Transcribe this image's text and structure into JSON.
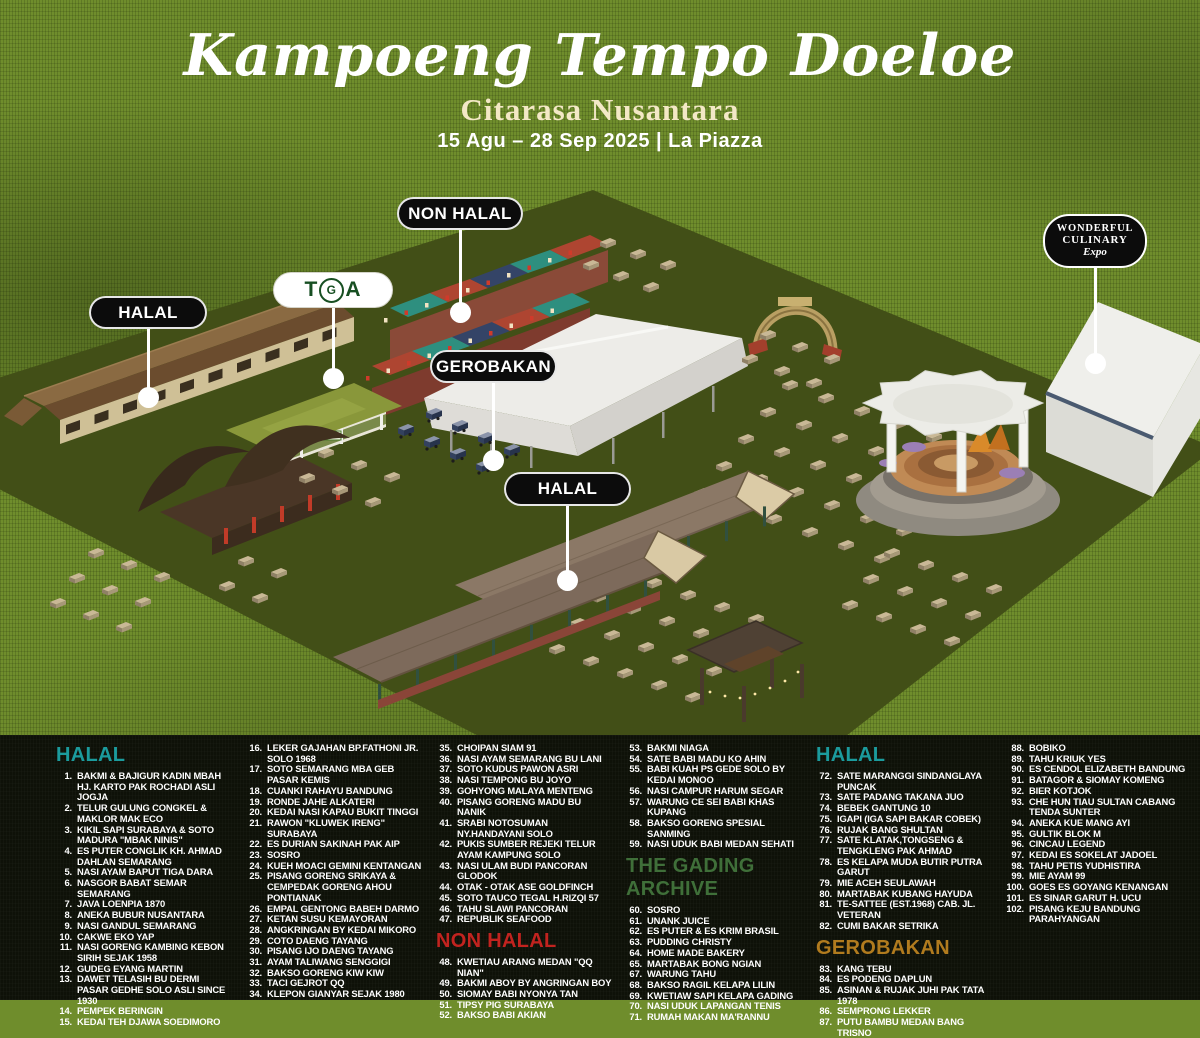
{
  "header": {
    "title": "Kampoeng Tempo Doeloe",
    "subtitle": "Citarasa Nusantara",
    "date_line": "15 Agu – 28 Sep 2025 | La Piazza"
  },
  "colors": {
    "halal_teal": "#1b9b9d",
    "non_halal_red": "#c2231f",
    "gading_green": "#3f6f39",
    "gerobakan_orange": "#b17b1e",
    "cream": "#f3e8c6",
    "ground_light": "#6f8d2c",
    "ground_dark": "#424f17",
    "panel_black": "#0e1108"
  },
  "map": {
    "labels": [
      {
        "id": "halal-west",
        "text": "HALAL",
        "style": "black"
      },
      {
        "id": "tga",
        "text": "TGA",
        "style": "tga"
      },
      {
        "id": "non-halal",
        "text": "NON HALAL",
        "style": "black"
      },
      {
        "id": "gerobakan",
        "text": "GEROBAKAN",
        "style": "black"
      },
      {
        "id": "halal-central",
        "text": "HALAL",
        "style": "black"
      },
      {
        "id": "wce",
        "style": "logo",
        "lines": [
          "WONDERFUL",
          "CULINARY",
          "Expo"
        ]
      }
    ]
  },
  "legend": {
    "columns": [
      {
        "blocks": [
          {
            "header": "HALAL",
            "color": "#1b9b9d"
          },
          {
            "items": [
              [
                "1",
                "BAKMI & BAJIGUR KADIN MBAH HJ. KARTO PAK ROCHADI ASLI JOGJA"
              ],
              [
                "2",
                "TELUR GULUNG CONGKEL & MAKLOR MAK ECO"
              ],
              [
                "3",
                "KIKIL SAPI SURABAYA & SOTO MADURA \"MBAK NINIS\""
              ],
              [
                "4",
                "ES PUTER CONGLIK KH. AHMAD DAHLAN SEMARANG"
              ],
              [
                "5",
                "NASI AYAM BAPUT TIGA DARA"
              ],
              [
                "6",
                "NASGOR BABAT SEMAR SEMARANG"
              ],
              [
                "7",
                "JAVA LOENPIA 1870"
              ],
              [
                "8",
                "ANEKA BUBUR NUSANTARA"
              ],
              [
                "9",
                "NASI GANDUL SEMARANG"
              ],
              [
                "10",
                "CAKWE EKO YAP"
              ],
              [
                "11",
                "NASI GORENG KAMBING KEBON SIRIH SEJAK 1958"
              ],
              [
                "12",
                "GUDEG EYANG MARTIN"
              ],
              [
                "13",
                "DAWET TELASIH BU DERMI PASAR GEDHE SOLO ASLI SINCE 1930"
              ],
              [
                "14",
                "PEMPEK BERINGIN"
              ],
              [
                "15",
                "KEDAI TEH DJAWA SOEDIMORO"
              ]
            ]
          }
        ]
      },
      {
        "blocks": [
          {
            "items": [
              [
                "16",
                "LEKER GAJAHAN BP.FATHONI JR. SOLO 1968"
              ],
              [
                "17",
                "SOTO SEMARANG MBA GEB PASAR KEMIS"
              ],
              [
                "18",
                "CUANKI RAHAYU BANDUNG"
              ],
              [
                "19",
                "RONDE JAHE ALKATERI"
              ],
              [
                "20",
                "KEDAI NASI KAPAU BUKIT TINGGI"
              ],
              [
                "21",
                "RAWON \"KLUWEK IRENG\" SURABAYA"
              ],
              [
                "22",
                "ES DURIAN SAKINAH PAK AIP"
              ],
              [
                "23",
                "SOSRO"
              ],
              [
                "24",
                "KUEH MOACI GEMINI KENTANGAN"
              ],
              [
                "25",
                "PISANG GORENG SRIKAYA & CEMPEDAK GORENG AHOU PONTIANAK"
              ],
              [
                "26",
                "EMPAL GENTONG BABEH DARMO"
              ],
              [
                "27",
                "KETAN SUSU KEMAYORAN"
              ],
              [
                "28",
                "ANGKRINGAN BY KEDAI MIKORO"
              ],
              [
                "29",
                "COTO DAENG TAYANG"
              ],
              [
                "30",
                "PISANG IJO DAENG TAYANG"
              ],
              [
                "31",
                "AYAM TALIWANG SENGGIGI"
              ],
              [
                "32",
                "BAKSO GORENG KIW KIW"
              ],
              [
                "33",
                "TACI GEJROT QQ"
              ],
              [
                "34",
                "KLEPON GIANYAR SEJAK 1980"
              ]
            ]
          }
        ]
      },
      {
        "blocks": [
          {
            "items": [
              [
                "35",
                "CHOIPAN SIAM 91"
              ],
              [
                "36",
                "NASI AYAM SEMARANG BU LANI"
              ],
              [
                "37",
                "SOTO KUDUS PAWON ASRI"
              ],
              [
                "38",
                "NASI TEMPONG BU JOYO"
              ],
              [
                "39",
                "GOHYONG MALAYA MENTENG"
              ],
              [
                "40",
                "PISANG GORENG MADU BU NANIK"
              ],
              [
                "41",
                "SRABI NOTOSUMAN NY.HANDAYANI SOLO"
              ],
              [
                "42",
                "PUKIS SUMBER REJEKI TELUR AYAM KAMPUNG SOLO"
              ],
              [
                "43",
                "NASI ULAM BUDI PANCORAN GLODOK"
              ],
              [
                "44",
                "OTAK - OTAK ASE GOLDFINCH"
              ],
              [
                "45",
                "SOTO TAUCO TEGAL H.RIZQI 57"
              ],
              [
                "46",
                "TAHU SLAWI PANCORAN"
              ],
              [
                "47",
                "REPUBLIK SEAFOOD"
              ]
            ]
          },
          {
            "header": "NON HALAL",
            "color": "#c2231f",
            "mid": true
          },
          {
            "items": [
              [
                "48",
                "KWETIAU ARANG MEDAN \"QQ NIAN\""
              ],
              [
                "49",
                "BAKMI ABOY BY ANGRINGAN BOY"
              ],
              [
                "50",
                "SIOMAY BABI NYONYA TAN"
              ],
              [
                "51",
                "TIPSY PIG SURABAYA"
              ],
              [
                "52",
                "BAKSO BABI AKIAN"
              ]
            ]
          }
        ]
      },
      {
        "blocks": [
          {
            "items": [
              [
                "53",
                "BAKMI NIAGA"
              ],
              [
                "54",
                "SATE BABI MADU KO AHIN"
              ],
              [
                "55",
                "BABI KUAH PS GEDE SOLO BY KEDAI MONOO"
              ],
              [
                "56",
                "NASI CAMPUR HARUM SEGAR"
              ],
              [
                "57",
                "WARUNG CE SEI BABI KHAS KUPANG"
              ],
              [
                "58",
                "BAKSO GORENG SPESIAL SANMING"
              ],
              [
                "59",
                "NASI UDUK BABI MEDAN SEHATI"
              ]
            ]
          },
          {
            "header": "THE GADING ARCHIVE",
            "color": "#3f6f39",
            "mid": true
          },
          {
            "items": [
              [
                "60",
                "SOSRO"
              ],
              [
                "61",
                "UNANK JUICE"
              ],
              [
                "62",
                "ES PUTER & ES KRIM BRASIL"
              ],
              [
                "63",
                "PUDDING CHRISTY"
              ],
              [
                "64",
                "HOME MADE BAKERY"
              ],
              [
                "65",
                "MARTABAK BONG NGIAN"
              ],
              [
                "67",
                "WARUNG TAHU"
              ],
              [
                "68",
                "BAKSO RAGIL KELAPA LILIN"
              ],
              [
                "69",
                "KWETIAW SAPI KELAPA GADING"
              ],
              [
                "70",
                "NASI UDUK LAPANGAN TENIS"
              ],
              [
                "71",
                "RUMAH MAKAN MA'RANNU"
              ]
            ]
          }
        ]
      },
      {
        "blocks": [
          {
            "header": "HALAL",
            "color": "#1b9b9d"
          },
          {
            "items": [
              [
                "72",
                "SATE MARANGGI SINDANGLAYA PUNCAK"
              ],
              [
                "73",
                "SATE PADANG TAKANA JUO"
              ],
              [
                "74",
                "BEBEK GANTUNG 10"
              ],
              [
                "75",
                "IGAPI (IGA SAPI BAKAR COBEK)"
              ],
              [
                "76",
                "RUJAK BANG SHULTAN"
              ],
              [
                "77",
                "SATE KLATAK,TONGSENG & TENGKLENG PAK AHMAD"
              ],
              [
                "78",
                "ES KELAPA MUDA BUTIR PUTRA GARUT"
              ],
              [
                "79",
                "MIE ACEH SEULAWAH"
              ],
              [
                "80",
                "MARTABAK KUBANG HAYUDA"
              ],
              [
                "81",
                "TE-SATTEE (EST.1968) CAB. JL. VETERAN"
              ],
              [
                "82",
                "CUMI BAKAR SETRIKA"
              ]
            ]
          },
          {
            "header": "GEROBAKAN",
            "color": "#b17b1e",
            "mid": true
          },
          {
            "items": [
              [
                "83",
                "KANG TEBU"
              ],
              [
                "84",
                "ES PODENG DAPLUN"
              ],
              [
                "85",
                "ASINAN & RUJAK JUHI PAK TATA 1978"
              ],
              [
                "86",
                "SEMPRONG LEKKER"
              ],
              [
                "87",
                "PUTU BAMBU MEDAN BANG TRISNO"
              ]
            ]
          }
        ]
      },
      {
        "blocks": [
          {
            "items": [
              [
                "88",
                "BOBIKO"
              ],
              [
                "89",
                "TAHU KRIUK YES"
              ],
              [
                "90",
                "ES CENDOL ELIZABETH BANDUNG"
              ],
              [
                "91",
                "BATAGOR & SIOMAY KOMENG"
              ],
              [
                "92",
                "BIER KOTJOK"
              ],
              [
                "93",
                "CHE HUN TIAU SULTAN CABANG TENDA SUNTER"
              ],
              [
                "94",
                "ANEKA KUE MANG AYI"
              ],
              [
                "95",
                "GULTIK BLOK M"
              ],
              [
                "96",
                "CINCAU LEGEND"
              ],
              [
                "97",
                "KEDAI ES SOKELAT JADOEL"
              ],
              [
                "98",
                "TAHU PETIS YUDHISTIRA"
              ],
              [
                "99",
                "MIE AYAM 99"
              ],
              [
                "100",
                "GOES ES GOYANG KENANGAN"
              ],
              [
                "101",
                "ES SINAR GARUT H. UCU"
              ],
              [
                "102",
                "PISANG KEJU BANDUNG PARAHYANGAN"
              ]
            ]
          }
        ]
      }
    ]
  }
}
